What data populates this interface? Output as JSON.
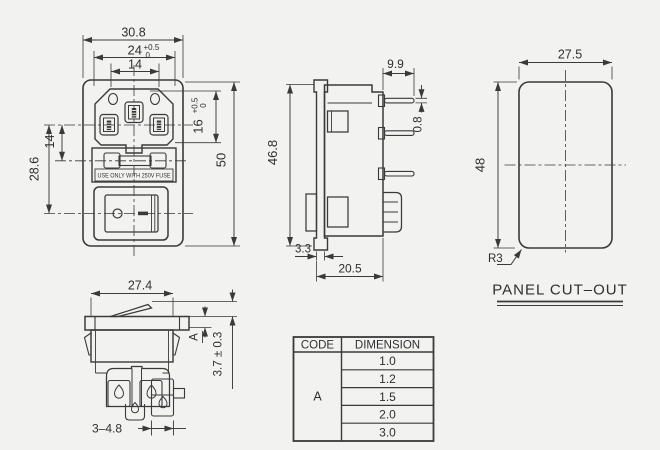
{
  "front": {
    "width": "30.8",
    "opening_w": "24",
    "opening_w_tol_top": "+0.5",
    "opening_w_tol_bot": "0",
    "pin_pitch": "14",
    "opening_h": "16",
    "opening_h_tol_top": "+0.5",
    "opening_h_tol_bot": "0",
    "height": "50",
    "pin_to_fuse": "14",
    "pin_to_switch": "28.6",
    "fuse_warning": "USE ONLY WITH 250V FUSE"
  },
  "side": {
    "height": "46.8",
    "pin_length": "9.9",
    "pin_thickness": "0.8",
    "flange_thickness": "3.3",
    "depth": "20.5"
  },
  "cutout": {
    "width": "27.5",
    "height": "48",
    "radius": "R3",
    "title": "PANEL CUT–OUT"
  },
  "switch": {
    "width": "27.4",
    "code": "A",
    "protrusion": "3.7 ± 0.3",
    "terminal": "3–4.8"
  },
  "table": {
    "header_code": "CODE",
    "header_dimension": "DIMENSION",
    "code": "A",
    "values": [
      "1.0",
      "1.2",
      "1.5",
      "2.0",
      "3.0"
    ]
  },
  "colors": {
    "line": "#3a3a3a",
    "background": "#f2f2f1"
  }
}
